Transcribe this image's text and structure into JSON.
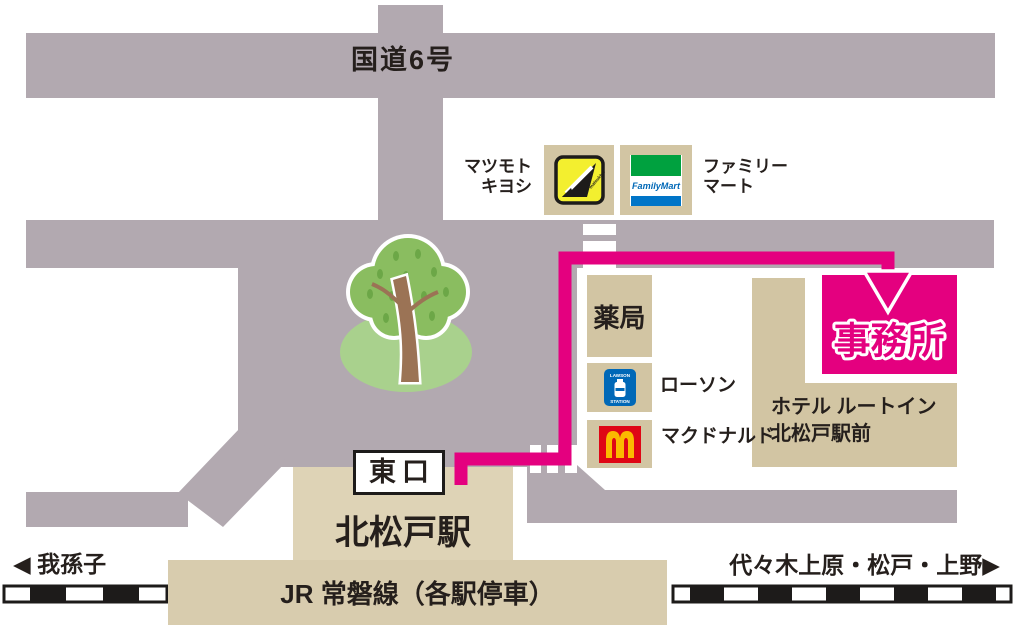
{
  "title": "北松戸駅周辺 アクセスマップ",
  "colors": {
    "road": "#b2a9b0",
    "building_tan": "#d2c5a3",
    "station_tan": "#ded3b6",
    "platform_tan": "#d8ccae",
    "route_magenta": "#e4007f",
    "text_dark": "#251f1c",
    "matsukiyo_yellow": "#f3ef2f",
    "familymart_green": "#00a13f",
    "familymart_blue": "#0075c8",
    "familymart_text_blue": "#0068b7",
    "lawson_blue": "#0068b7",
    "mcdonalds_red": "#df0615",
    "mcdonalds_yellow": "#fbba00",
    "tree_green": "#8abd60",
    "tree_leaf_dark": "#6ca747",
    "tree_mound": "#a9d18d",
    "tree_trunk": "#9b7355"
  },
  "labels": {
    "route6": "国道6号",
    "matsukiyo": {
      "line1": "マツモト",
      "line2": "キヨシ",
      "logo_text": "matsukiyo"
    },
    "familymart": {
      "line1": "ファミリー",
      "line2": "マート",
      "logo_text": "FamilyMart"
    },
    "pharmacy": "薬局",
    "lawson": {
      "label": "ローソン",
      "logo_top": "LAWSON",
      "logo_bottom": "STATION"
    },
    "mcdonalds": {
      "label": "マクドナルド"
    },
    "office": "事務所",
    "hotel": {
      "line1": "ホテル ルートイン",
      "line2": "北松戸駅前"
    },
    "east_exit": "東口",
    "station_name": "北松戸駅",
    "line_name": "JR 常磐線（各駅停車）",
    "direction_left": {
      "arrow": "◀",
      "text": "我孫子"
    },
    "direction_right": {
      "text": "代々木上原・松戸・上野",
      "arrow": "▶"
    }
  }
}
